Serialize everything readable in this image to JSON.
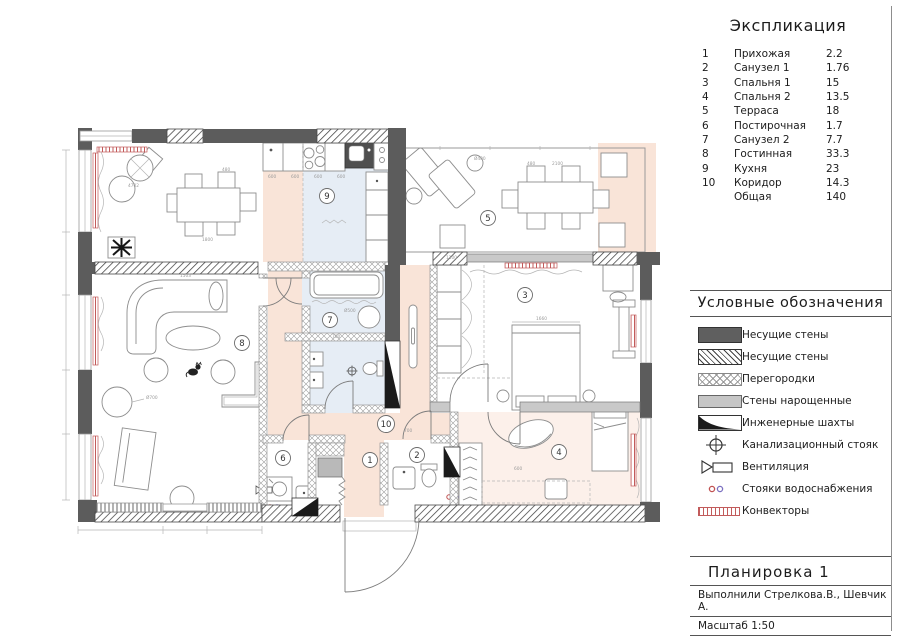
{
  "explication": {
    "title": "Экспликация",
    "rows": [
      {
        "n": "1",
        "name": "Прихожая",
        "area": "2.2"
      },
      {
        "n": "2",
        "name": "Санузел 1",
        "area": "1.76"
      },
      {
        "n": "3",
        "name": "Спальня 1",
        "area": "15"
      },
      {
        "n": "4",
        "name": "Спальня 2",
        "area": "13.5"
      },
      {
        "n": "5",
        "name": "Терраса",
        "area": "18"
      },
      {
        "n": "6",
        "name": "Постирочная",
        "area": "1.7"
      },
      {
        "n": "7",
        "name": "Санузел 2",
        "area": "7.7"
      },
      {
        "n": "8",
        "name": "Гостинная",
        "area": "33.3"
      },
      {
        "n": "9",
        "name": "Кухня",
        "area": "23"
      },
      {
        "n": "10",
        "name": "Коридор",
        "area": "14.3"
      },
      {
        "n": "",
        "name": "Общая",
        "area": "140"
      }
    ]
  },
  "legend": {
    "title": "Условные обозначения",
    "items": [
      {
        "symbol": "solid-dark-wall",
        "label": "Несущие стены"
      },
      {
        "symbol": "hatched-wall",
        "label": "Несущие стены"
      },
      {
        "symbol": "cross-hatch-partition",
        "label": "Перегородки"
      },
      {
        "symbol": "light-gray-wall",
        "label": "Стены нарощенные"
      },
      {
        "symbol": "engineering-shaft",
        "label": "Инженерные шахты"
      },
      {
        "symbol": "sewer-riser",
        "label": "Канализационный стояк"
      },
      {
        "symbol": "ventilation",
        "label": "Вентиляция"
      },
      {
        "symbol": "water-risers",
        "label": "Стояки водоснабжения"
      },
      {
        "symbol": "convector",
        "label": "Конвекторы"
      }
    ]
  },
  "title_block": {
    "title": "Планировка 1",
    "authors": "Выполнили Стрелкова.В., Шевчик А.",
    "scale": "Масштаб 1:50"
  },
  "plan": {
    "room_labels": [
      {
        "n": "1"
      },
      {
        "n": "2"
      },
      {
        "n": "3"
      },
      {
        "n": "4"
      },
      {
        "n": "5"
      },
      {
        "n": "6"
      },
      {
        "n": "7"
      },
      {
        "n": "8"
      },
      {
        "n": "9"
      },
      {
        "n": "10"
      }
    ],
    "dimensions": [
      {
        "text": "4702"
      },
      {
        "text": "480"
      },
      {
        "text": "1800"
      },
      {
        "text": "1503"
      },
      {
        "text": "Ø700"
      },
      {
        "text": "Ø500"
      },
      {
        "text": "700"
      },
      {
        "text": "600"
      },
      {
        "text": "600"
      },
      {
        "text": "600"
      },
      {
        "text": "600"
      },
      {
        "text": "480"
      },
      {
        "text": "2100"
      },
      {
        "text": "Ø400"
      },
      {
        "text": "1660"
      },
      {
        "text": "1100"
      },
      {
        "text": "600"
      },
      {
        "text": "700"
      }
    ]
  },
  "colors": {
    "wall_dark": "#5c5c5c",
    "convector_red": "#c25b5b",
    "zone_peach": "#f9e4d8",
    "zone_blue": "#e6edf5",
    "zone_pink": "#fcf0ea"
  }
}
